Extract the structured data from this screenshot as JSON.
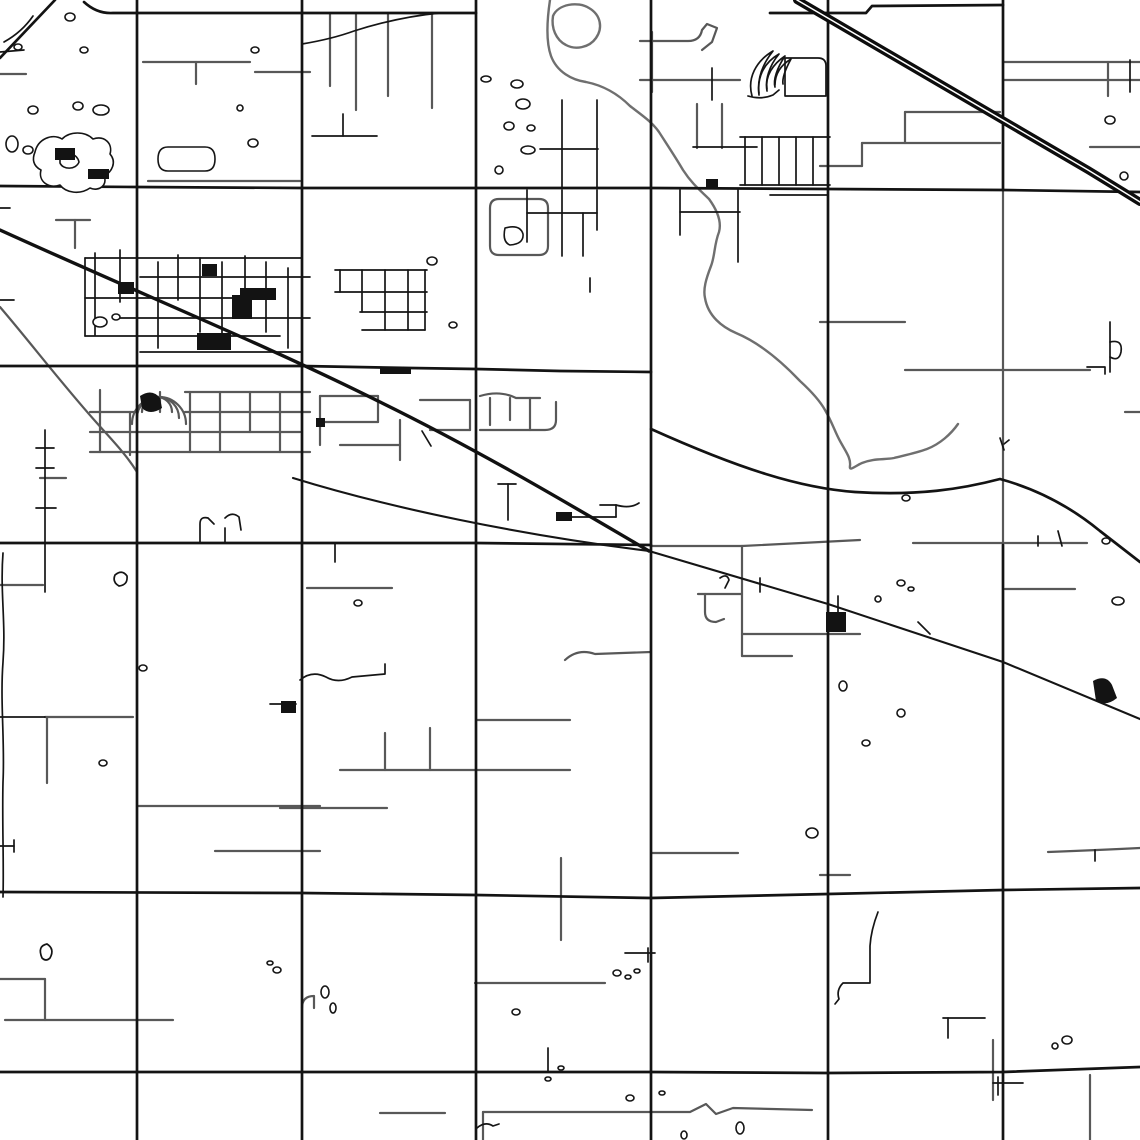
{
  "map": {
    "canvas": {
      "width": 1140,
      "height": 1140,
      "background": "#ffffff"
    },
    "palette": {
      "road_major": "#131313",
      "road_minor": "#585858",
      "river": "#6f6f6f",
      "water_fill": "#ffffff",
      "highway_casing": "#0d0d0d",
      "highway_center": "#ffffff"
    },
    "layers": [
      {
        "name": "minor-roads",
        "stroke": "#585858",
        "width": 2.2,
        "paths": [
          "M143,62 H250",
          "M196,62 V84",
          "M255,72 H310",
          "M0,74 H26",
          "M330,13 V86",
          "M356,13 V110",
          "M388,13 V96",
          "M432,13 V108",
          "M56,220 H90",
          "M75,220 V248",
          "M148,181 H300",
          "M640,41 H688 Q700,41 702,30 L707,24 L717,28 L712,42 L702,50",
          "M640,80 H740",
          "M697,104 V148",
          "M722,104 V148",
          "M652,32 V92",
          "M820,322 H905",
          "M905,370 H1090",
          "M1003,62 H1140",
          "M1003,80 H1140",
          "M1108,62 V96",
          "M1090,147 H1140",
          "M905,112 H1000",
          "M905,112 V143",
          "M862,143 H1000",
          "M862,143 V166",
          "M820,166 H862",
          "M1125,412 H1140",
          "M1005,589 H1075",
          "M651,546 H742",
          "M742,546 Q800,543 860,540",
          "M742,634 H860",
          "M742,656 H792",
          "M698,594 H742",
          "M705,594 V612 Q705,622 716,622 L724,619",
          "M742,546 V656",
          "M652,853 H738",
          "M820,875 H850",
          "M1048,852 Q1100,850 1140,848",
          "M307,588 H392",
          "M340,770 H570",
          "M385,733 V770",
          "M430,728 V770",
          "M477,720 H570",
          "M280,808 H387",
          "M565,660 Q578,648 595,654 L651,652",
          "M0,585 H43",
          "M40,478 H66",
          "M45,717 H133",
          "M47,717 V783",
          "M137,806 H320",
          "M215,851 H320",
          "M0,979 H45",
          "M45,979 V1020",
          "M5,1020 H173",
          "M380,1113 H445",
          "M483,1112 H690 L706,1104 L716,1114 L733,1108 L812,1110",
          "M483,1112 V1140",
          "M475,983 H605",
          "M561,858 V940",
          "M993,1040 V1100",
          "M1090,1075 V1140",
          "M0,307 C30,342 62,384 96,422 C110,438 126,454 137,472",
          "M490,208 Q490,199 499,199 L539,199 Q548,199 548,208 L548,246 Q548,255 539,255 L499,255 Q490,255 490,246 Z",
          "M302,1008 Q302,996 314,996 L314,1008",
          "M1003,190 V545",
          "M913,543 H1087",
          "M90,432 H300",
          "M90,452 H310",
          "M185,392 H310",
          "M90,412 H135",
          "M185,412 H310",
          "M100,390 V452",
          "M130,412 V455",
          "M160,392 V412",
          "M190,392 V452",
          "M220,392 V452",
          "M250,392 V432",
          "M280,392 V452",
          "M142,412 A15,15 0 0 1 172,412",
          "M137,418 A21,21 0 0 1 179,418",
          "M132,424 A27,27 0 0 1 186,424",
          "M320,396 H378",
          "M378,396 V422",
          "M320,422 H378",
          "M320,396 V445",
          "M340,445 H400",
          "M400,420 V460",
          "M420,400 H470",
          "M470,400 V430",
          "M430,430 H470",
          "M480,396 Q500,390 516,398 L540,398",
          "M490,398 V425",
          "M510,398 V420",
          "M530,398 V430",
          "M480,430 L545,430 Q556,430 556,420 L556,402"
        ]
      },
      {
        "name": "river",
        "stroke": "#6f6f6f",
        "width": 2.4,
        "paths": [
          "M550,0 C547,20 546,42 551,56 C557,72 572,80 586,82 C606,86 620,96 630,106 C643,116 652,122 659,132 C668,146 676,158 683,170 C692,184 701,191 709,199 C717,210 722,221 719,232 C714,245 715,256 711,266 C706,279 703,289 705,298 C708,316 722,327 736,333 C760,343 782,362 800,381 C812,392 820,401 825,410 C832,422 835,432 840,441 C846,452 851,458 850,466 C849,472 855,466 862,463 C874,458 884,460 894,458 C906,455 916,453 927,449 C940,444 951,434 958,424",
          "M553,16 C558,4 578,1 589,8 C601,15 603,28 596,38 C589,48 575,50 566,45 C556,40 551,28 553,16 Z"
        ]
      },
      {
        "name": "town-streets",
        "stroke": "#151515",
        "width": 1.7,
        "paths": [
          "M85,258 V336",
          "M95,253 V335",
          "M120,250 V302",
          "M158,262 V348",
          "M178,255 V300",
          "M200,258 V332",
          "M222,262 V348",
          "M245,256 V302",
          "M266,262 V332",
          "M288,268 V348",
          "M85,258 H302",
          "M140,277 H310",
          "M85,298 H266",
          "M120,318 H310",
          "M85,336 H280",
          "M140,352 H302",
          "M335,270 H427",
          "M335,292 H427",
          "M360,312 H427",
          "M340,270 V292",
          "M362,270 V312",
          "M385,270 V330",
          "M408,270 V330",
          "M425,270 V330",
          "M362,330 H425",
          "M312,136 H377",
          "M343,114 V136",
          "M45,430 V592",
          "M36,448 H54",
          "M36,468 H54",
          "M36,508 H56",
          "M0,717 H45",
          "M3,553 C0,592 6,622 3,662 C0,702 5,742 3,782 C2,822 4,862 3,897",
          "M0,846 H14",
          "M14,840 V852",
          "M42,958 Q37,946 47,944 Q55,949 50,958 Q46,962 42,958",
          "M200,543 V524 Q200,516 208,518 L214,524",
          "M225,543 V528",
          "M225,518 Q232,511 239,517 L241,530",
          "M115,575 Q122,569 127,576 Q128,585 119,586 Q112,582 115,575",
          "M300,680 Q312,670 326,677 Q338,684 352,677 L385,674 V664",
          "M270,704 H296",
          "M335,543 V562",
          "M422,431 L431,446",
          "M508,484 V520",
          "M498,484 H516",
          "M572,517 H616",
          "M616,517 V505",
          "M600,505 H616",
          "M616,505 Q630,509 639,503",
          "M590,278 V292",
          "M562,100 V187",
          "M597,100 V187",
          "M540,149 H598",
          "M527,190 V242",
          "M562,190 V256",
          "M597,190 V230",
          "M583,213 V256",
          "M527,213 H597",
          "M680,190 V235",
          "M680,212 H740",
          "M738,190 V262",
          "M712,68 V100",
          "M693,147 H757",
          "M748,96 Q761,100 773,95 L779,90",
          "M785,58 H818 Q826,58 826,66 V96 H785 V58",
          "M770,195 H828",
          "M740,137 H830",
          "M740,185 H830",
          "M745,137 V185",
          "M762,137 V185",
          "M779,137 V185",
          "M796,137 V185",
          "M813,137 V185",
          "M752,96 C747,78 756,61 773,51 C761,66 757,80 759,95",
          "M759,93 C757,76 765,62 779,54 C769,66 765,80 767,91",
          "M767,89 C765,76 773,64 785,56 C777,68 773,80 775,87",
          "M775,85 C775,73 781,65 791,59 C785,70 782,78 783,84",
          "M918,622 L930,634",
          "M838,596 V612",
          "M760,578 V592",
          "M720,578 Q727,573 729,580 L725,588",
          "M548,1048 V1072",
          "M625,953 H655",
          "M648,948 V962",
          "M477,1128 Q485,1121 493,1126 L499,1124",
          "M943,1018 H985",
          "M948,1018 V1038",
          "M993,1083 H1023",
          "M998,1077 V1095",
          "M878,912 Q871,930 870,946 V983 H843 Q836,990 839,999 L835,1004",
          "M1095,850 V861",
          "M1110,322 V372",
          "M1110,342 Q1123,339 1121,352 Q1119,362 1110,357",
          "M1087,367 H1105 V374",
          "M1000,438 L1004,450",
          "M1004,444 L1009,440",
          "M1038,536 V546",
          "M1058,531 L1062,546",
          "M33,16 Q22,32 4,42",
          "M0,52 L24,50",
          "M302,44 Q332,39 354,31 Q398,17 440,13",
          "M0,208 H10",
          "M0,300 H14",
          "M1130,60 V92"
        ]
      },
      {
        "name": "major-roads",
        "stroke": "#131313",
        "width": 2.7,
        "paths": [
          "M137,0 V1140",
          "M302,0 V1140",
          "M476,0 V1140",
          "M651,0 V1140",
          "M828,0 V1140",
          "M1003,0 V190",
          "M1003,545 V1140",
          "M84,2 Q97,14 113,13 L137,13 H476",
          "M770,13 L866,13 L872,6 L1003,5",
          "M0,186 L137,187 L302,188 L476,188 L651,188 L828,189 L1003,190 L1140,192",
          "M0,366 H302 L410,368 L476,369 L560,371 L651,372",
          "M0,543 H476 L651,545",
          "M0,892 L302,893 L476,895 L651,898 L828,894 L1003,890 L1140,888",
          "M0,1072 H476 L651,1072 L828,1073 L1003,1072 L1140,1067",
          "M651,429 C740,469 800,488 855,492 C918,496 962,489 1000,479 Q1055,494 1100,531 Q1122,548 1140,562",
          "M55,0 L0,58"
        ]
      },
      {
        "name": "railroad-diagonal",
        "stroke": "#111111",
        "width": 3.4,
        "paths": [
          "M0,230 C150,298 268,346 380,402 C488,455 582,512 649,551"
        ]
      },
      {
        "name": "diagonal-roads",
        "stroke": "#151515",
        "width": 2.1,
        "paths": [
          "M649,551 L828,604 L1003,662 L1140,719",
          "M293,478 C390,508 520,535 649,551"
        ]
      },
      {
        "name": "divided-highway-casing",
        "stroke": "#0d0d0d",
        "width": 8,
        "paths": [
          "M797,0 L1088,170 Q1124,192 1140,202"
        ]
      },
      {
        "name": "divided-highway-centerline",
        "stroke": "#ffffff",
        "width": 1.5,
        "paths": [
          "M797,0 L1088,170 Q1124,192 1140,202"
        ]
      },
      {
        "name": "water-bodies",
        "stroke": "#151515",
        "width": 1.6,
        "fill": "#ffffff",
        "paths": [
          "M35,152 C38,139 52,133 62,139 C70,131 85,131 93,139 C105,135 113,144 110,154 C117,162 112,172 104,176 C108,185 99,192 90,188 C80,195 66,193 60,185 C48,189 38,181 41,170 C33,166 32,159 35,152 Z",
          "M60,158 C66,151 77,153 79,162 C76,170 63,170 60,163 Z",
          "M168,147 L205,147 Q215,147 215,159 Q215,171 205,171 L168,171 Q158,171 158,159 Q158,147 168,147 Z",
          "M505,228 Q520,224 523,234 Q524,244 510,245 Q502,242 505,228 Z",
          "M65,17 a5,4 0 1 0 10,0 a5,4 0 1 0 -10,0 Z",
          "M14,47 a4,3 0 1 0 8,0 a4,3 0 1 0 -8,0 Z",
          "M80,50 a4,3 0 1 0 8,0 a4,3 0 1 0 -8,0 Z",
          "M28,110 a5,4 0 1 0 10,0 a5,4 0 1 0 -10,0 Z",
          "M73,106 a5,4 0 1 0 10,0 a5,4 0 1 0 -10,0 Z",
          "M93,110 a8,5 0 1 0 16,0 a8,5 0 1 0 -16,0 Z",
          "M248,143 a5,4 0 1 0 10,0 a5,4 0 1 0 -10,0 Z",
          "M251,50 a4,3 0 1 0 8,0 a4,3 0 1 0 -8,0 Z",
          "M237,108 a3,3 0 1 0 6,0 a3,3 0 1 0 -6,0 Z",
          "M93,322 a7,5 0 1 0 14,0 a7,5 0 1 0 -14,0 Z",
          "M112,317 a4,3 0 1 0 8,0 a4,3 0 1 0 -8,0 Z",
          "M6,144 a6,8 0 1 0 12,0 a6,8 0 1 0 -12,0 Z",
          "M23,150 a5,4 0 1 0 10,0 a5,4 0 1 0 -10,0 Z",
          "M427,261 a5,4 0 1 0 10,0 a5,4 0 1 0 -10,0 Z",
          "M449,325 a4,3 0 1 0 8,0 a4,3 0 1 0 -8,0 Z",
          "M481,79 a5,3 0 1 0 10,0 a5,3 0 1 0 -10,0 Z",
          "M511,84 a6,4 0 1 0 12,0 a6,4 0 1 0 -12,0 Z",
          "M516,104 a7,5 0 1 0 14,0 a7,5 0 1 0 -14,0 Z",
          "M504,126 a5,4 0 1 0 10,0 a5,4 0 1 0 -10,0 Z",
          "M527,128 a4,3 0 1 0 8,0 a4,3 0 1 0 -8,0 Z",
          "M495,170 a4,4 0 1 0 8,0 a4,4 0 1 0 -8,0 Z",
          "M521,150 a7,4 0 1 0 14,0 a7,4 0 1 0 -14,0 Z",
          "M902,498 a4,3 0 1 0 8,0 a4,3 0 1 0 -8,0 Z",
          "M897,583 a4,3 0 1 0 8,0 a4,3 0 1 0 -8,0 Z",
          "M908,589 a3,2 0 1 0 6,0 a3,2 0 1 0 -6,0 Z",
          "M875,599 a3,3 0 1 0 6,0 a3,3 0 1 0 -6,0 Z",
          "M839,686 a4,5 0 1 0 8,0 a4,5 0 1 0 -8,0 Z",
          "M897,713 a4,4 0 1 0 8,0 a4,4 0 1 0 -8,0 Z",
          "M862,743 a4,3 0 1 0 8,0 a4,3 0 1 0 -8,0 Z",
          "M1102,541 a4,3 0 1 0 8,0 a4,3 0 1 0 -8,0 Z",
          "M1105,120 a5,4 0 1 0 10,0 a5,4 0 1 0 -10,0 Z",
          "M1120,176 a4,4 0 1 0 8,0 a4,4 0 1 0 -8,0 Z",
          "M806,833 a6,5 0 1 0 12,0 a6,5 0 1 0 -12,0 Z",
          "M1062,1040 a5,4 0 1 0 10,0 a5,4 0 1 0 -10,0 Z",
          "M1052,1046 a3,3 0 1 0 6,0 a3,3 0 1 0 -6,0 Z",
          "M613,973 a4,3 0 1 0 8,0 a4,3 0 1 0 -8,0 Z",
          "M625,977 a3,2 0 1 0 6,0 a3,2 0 1 0 -6,0 Z",
          "M634,971 a3,2 0 1 0 6,0 a3,2 0 1 0 -6,0 Z",
          "M558,1068 a3,2 0 1 0 6,0 a3,2 0 1 0 -6,0 Z",
          "M512,1012 a4,3 0 1 0 8,0 a4,3 0 1 0 -8,0 Z",
          "M626,1098 a4,3 0 1 0 8,0 a4,3 0 1 0 -8,0 Z",
          "M659,1093 a3,2 0 1 0 6,0 a3,2 0 1 0 -6,0 Z",
          "M681,1135 a3,4 0 1 0 6,0 a3,4 0 1 0 -6,0 Z",
          "M736,1128 a4,6 0 1 0 8,0 a4,6 0 1 0 -8,0 Z",
          "M545,1079 a3,2 0 1 0 6,0 a3,2 0 1 0 -6,0 Z",
          "M354,603 a4,3 0 1 0 8,0 a4,3 0 1 0 -8,0 Z",
          "M139,668 a4,3 0 1 0 8,0 a4,3 0 1 0 -8,0 Z",
          "M99,763 a4,3 0 1 0 8,0 a4,3 0 1 0 -8,0 Z",
          "M273,970 a4,3 0 1 0 8,0 a4,3 0 1 0 -8,0 Z",
          "M267,963 a3,2 0 1 0 6,0 a3,2 0 1 0 -6,0 Z",
          "M321,992 a4,6 0 1 0 8,0 a4,6 0 1 0 -8,0 Z",
          "M330,1008 a3,5 0 1 0 6,0 a3,5 0 1 0 -6,0 Z",
          "M1112,601 a6,4 0 1 0 12,0 a6,4 0 1 0 -12,0 Z"
        ]
      },
      {
        "name": "built-areas",
        "stroke": "none",
        "fill": "#131313",
        "paths": [
          "M197,333 h34 v17 h-34 Z",
          "M240,288 h36 v12 h-36 Z",
          "M118,282 h16 v12 h-16 Z",
          "M380,367 h31 v7 h-31 Z",
          "M316,418 h9 v9 h-9 Z",
          "M826,612 h20 v20 h-20 Z",
          "M556,512 h16 v9 h-16 Z",
          "M281,701 h15 v12 h-15 Z",
          "M706,179 h12 v9 h-12 Z",
          "M232,295 h20 v24 h-20 Z",
          "M202,264 h15 v12 h-15 Z",
          "M140,396 q12,-8 20,2 l2,10 q-12,8 -20,0 Z",
          "M1093,681 q13,-7 19,4 l5,13 q-11,9 -21,3 Z",
          "M55,148 h20 v12 h-20 Z",
          "M88,169 h21 v10 h-21 Z"
        ]
      }
    ]
  }
}
